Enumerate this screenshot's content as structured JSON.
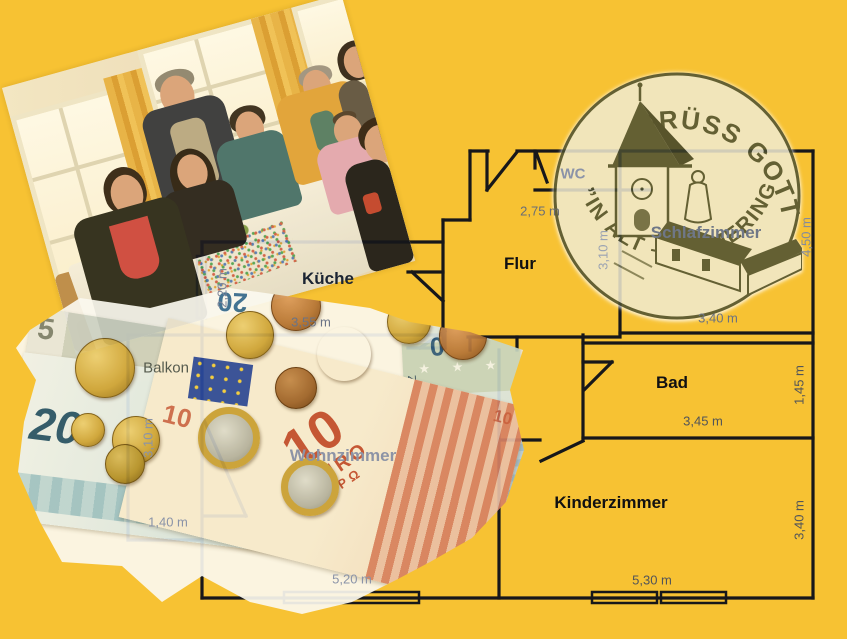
{
  "colors": {
    "background": "#F7C233",
    "wall": "#17171a",
    "stamp_ink": "#4c5033",
    "stamp_paper": "#f1ebd1",
    "note20_accent": "#24556f",
    "note10_accent": "#c14f35"
  },
  "floor_plan": {
    "rooms": [
      {
        "id": "wc",
        "label": "WC",
        "x": 573,
        "y": 174,
        "size": 15,
        "bold": true,
        "color": "#8b93a8"
      },
      {
        "id": "flur",
        "label": "Flur",
        "x": 520,
        "y": 264,
        "size": 17,
        "bold": true,
        "color": "#101012"
      },
      {
        "id": "schlafzimmer",
        "label": "Schlafzimmer",
        "x": 706,
        "y": 233,
        "size": 17,
        "bold": true,
        "color": "#6f7787"
      },
      {
        "id": "kueche",
        "label": "Küche",
        "x": 328,
        "y": 279,
        "size": 17,
        "bold": true,
        "color": "#1b2433"
      },
      {
        "id": "bad",
        "label": "Bad",
        "x": 672,
        "y": 383,
        "size": 17,
        "bold": true,
        "color": "#101012"
      },
      {
        "id": "balkon",
        "label": "Balkon",
        "x": 166,
        "y": 368,
        "size": 15,
        "bold": false,
        "color": "#565b4e"
      },
      {
        "id": "wohnzimmer",
        "label": "Wohnzimmer",
        "x": 343,
        "y": 456,
        "size": 17,
        "bold": true,
        "color": "#8d94a6"
      },
      {
        "id": "kinderzimmer",
        "label": "Kinderzimmer",
        "x": 611,
        "y": 503,
        "size": 17,
        "bold": true,
        "color": "#101012"
      }
    ],
    "dimensions": [
      {
        "label": "2,75 m",
        "x": 540,
        "y": 211,
        "rot": 0,
        "color": "#686d76"
      },
      {
        "label": "2,20 m",
        "x": 222,
        "y": 288,
        "rot": -90,
        "color": "#7c8498"
      },
      {
        "label": "3,55 m",
        "x": 311,
        "y": 322,
        "rot": 0,
        "color": "#6a7386"
      },
      {
        "label": "3,10 m",
        "x": 148,
        "y": 438,
        "rot": -90,
        "color": "#8a93a8"
      },
      {
        "label": "1,40 m",
        "x": 168,
        "y": 522,
        "rot": 0,
        "color": "#8a93a8"
      },
      {
        "label": "5,20 m",
        "x": 352,
        "y": 579,
        "rot": 0,
        "color": "#8a93a8"
      },
      {
        "label": "3,10 m",
        "x": 603,
        "y": 250,
        "rot": -90,
        "color": "#9aa2b2"
      },
      {
        "label": "3,40 m",
        "x": 718,
        "y": 318,
        "rot": 0,
        "color": "#6b7280"
      },
      {
        "label": "4,50 m",
        "x": 806,
        "y": 237,
        "rot": -90,
        "color": "#848b9c"
      },
      {
        "label": "3,45 m",
        "x": 703,
        "y": 421,
        "rot": 0,
        "color": "#515459"
      },
      {
        "label": "1,45 m",
        "x": 799,
        "y": 385,
        "rot": -90,
        "color": "#515459"
      },
      {
        "label": "5,30 m",
        "x": 652,
        "y": 580,
        "rot": 0,
        "color": "#515459"
      },
      {
        "label": "3,40 m",
        "x": 799,
        "y": 520,
        "rot": -90,
        "color": "#515459"
      }
    ]
  },
  "stamp": {
    "line1": "GRÜSS GOTT",
    "line2": "”IN ALT – SIMMERING"
  },
  "money": {
    "notes": {
      "n20": {
        "value": "20",
        "currency": "EURO",
        "currency2": "ΕΥΡΩ"
      },
      "n10": {
        "value": "10",
        "currency": "EURO",
        "currency2": "ΕΥΡΩ"
      },
      "n5": {
        "value": "5"
      },
      "n20r": {
        "value": "20",
        "serial": "X13112Z",
        "stars": "★ ★ ★"
      }
    },
    "coins": [
      {
        "x": 95,
        "y": 88,
        "r": 30,
        "type": "gold"
      },
      {
        "x": 78,
        "y": 150,
        "r": 17,
        "type": "gold"
      },
      {
        "x": 126,
        "y": 160,
        "r": 24,
        "type": "gold"
      },
      {
        "x": 115,
        "y": 184,
        "r": 20,
        "type": "gold2"
      },
      {
        "x": 240,
        "y": 55,
        "r": 24,
        "type": "gold"
      },
      {
        "x": 286,
        "y": 26,
        "r": 25,
        "type": "bronze"
      },
      {
        "x": 334,
        "y": 74,
        "r": 27,
        "type": "brass"
      },
      {
        "x": 286,
        "y": 108,
        "r": 21,
        "type": "bronze2"
      },
      {
        "x": 399,
        "y": 42,
        "r": 22,
        "type": "gold"
      },
      {
        "x": 453,
        "y": 56,
        "r": 24,
        "type": "bronze"
      },
      {
        "x": 219,
        "y": 158,
        "r": 31,
        "type": "euro"
      },
      {
        "x": 300,
        "y": 207,
        "r": 29,
        "type": "euro"
      }
    ]
  }
}
